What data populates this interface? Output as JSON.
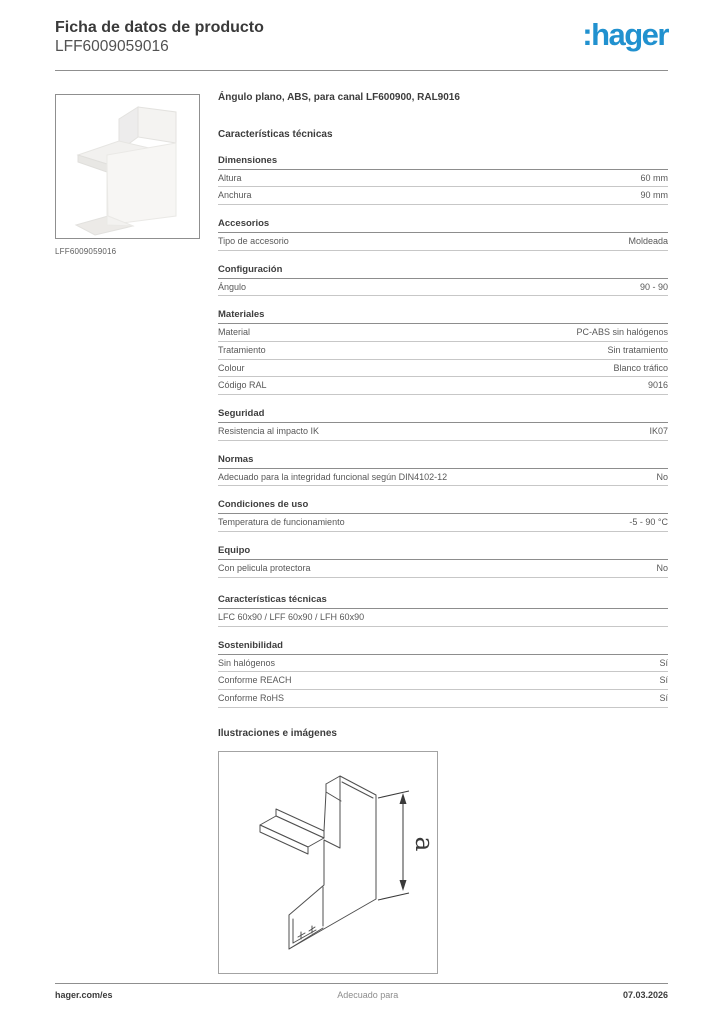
{
  "header": {
    "title": "Ficha de datos de producto",
    "subtitle": "LFF6009059016",
    "logo_text": ":hager",
    "logo_color": "#2191cf"
  },
  "product": {
    "image_caption": "LFF6009059016",
    "title": "Ángulo plano, ABS, para canal LF600900, RAL9016"
  },
  "tech": {
    "heading": "Características técnicas",
    "sections": [
      {
        "title": "Dimensiones",
        "rows": [
          {
            "label": "Altura",
            "value": "60 mm"
          },
          {
            "label": "Anchura",
            "value": "90 mm"
          }
        ]
      },
      {
        "title": "Accesorios",
        "rows": [
          {
            "label": "Tipo de accesorio",
            "value": "Moldeada"
          }
        ]
      },
      {
        "title": "Configuración",
        "rows": [
          {
            "label": "Ángulo",
            "value": "90 - 90"
          }
        ]
      },
      {
        "title": "Materiales",
        "rows": [
          {
            "label": "Material",
            "value": "PC-ABS sin halógenos"
          },
          {
            "label": "Tratamiento",
            "value": "Sin tratamiento"
          },
          {
            "label": "Colour",
            "value": "Blanco tráfico"
          },
          {
            "label": "Código RAL",
            "value": "9016"
          }
        ]
      },
      {
        "title": "Seguridad",
        "rows": [
          {
            "label": "Resistencia al impacto IK",
            "value": "IK07"
          }
        ]
      },
      {
        "title": "Normas",
        "rows": [
          {
            "label": "Adecuado para la integridad funcional según DIN4102-12",
            "value": "No"
          }
        ]
      },
      {
        "title": "Condiciones de uso",
        "rows": [
          {
            "label": "Temperatura de funcionamiento",
            "value": "-5 - 90 °C"
          }
        ]
      },
      {
        "title": "Equipo",
        "rows": [
          {
            "label": "Con pelicula protectora",
            "value": "No"
          }
        ]
      }
    ]
  },
  "extra": {
    "sections": [
      {
        "title": "Características técnicas",
        "rows": [
          {
            "label": "LFC 60x90 / LFF 60x90 / LFH 60x90",
            "value": ""
          }
        ]
      },
      {
        "title": "Sostenibilidad",
        "rows": [
          {
            "label": "Sin halógenos",
            "value": "Sí"
          },
          {
            "label": "Conforme REACH",
            "value": "Sí"
          },
          {
            "label": "Conforme RoHS",
            "value": "Sí"
          }
        ]
      }
    ]
  },
  "illustrations": {
    "heading": "Ilustraciones e imágenes",
    "dimension_label": "a"
  },
  "footer": {
    "left": "hager.com/es",
    "center": "Adecuado para",
    "right": "07.03.2026"
  }
}
